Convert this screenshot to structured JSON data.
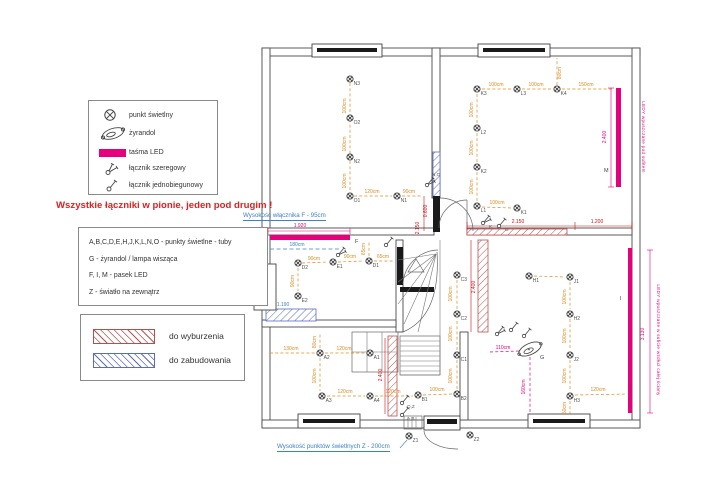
{
  "colors": {
    "led": "#e6007e",
    "dim_orange": "#dd8a1e",
    "dim_red": "#cc1111",
    "blue": "#3b82c4",
    "hatch_red": "#c0504d",
    "hatch_blue": "#5b6bbf",
    "wall": "#4a4a4a",
    "label": "#555555"
  },
  "symbol_legend": {
    "items": [
      {
        "icon": "light-point-icon",
        "label": "punkt świetlny"
      },
      {
        "icon": "chandelier-icon",
        "label": "żyrandol"
      },
      {
        "icon": "led-strip-icon",
        "label": "taśma LED"
      },
      {
        "icon": "series-switch-icon",
        "label": "łącznik szeregowy"
      },
      {
        "icon": "single-pole-switch-icon",
        "label": "łącznik jednobiegunowy"
      }
    ]
  },
  "warning": "Wszystkie łączniki w pionie, jeden pod drugim !",
  "letter_legend": {
    "lines": [
      "A,B,C,D,E,H,J,K,L,N,O - punkty świetlne - tuby",
      "G - żyrandol / lampa wisząca",
      "F, I, M - pasek LED",
      "Z - światło na zewnątrz"
    ]
  },
  "hatch_legend": {
    "items": [
      {
        "variant": "red",
        "label": "do wyburzenia"
      },
      {
        "variant": "blue",
        "label": "do zabudowania"
      }
    ]
  },
  "annotations": {
    "switch_f": "Wysokość włącznika F - 95cm",
    "lights_z": "Wysokość punktów świetlnych Z - 200cm"
  },
  "plan": {
    "walls": [
      [
        262,
        48,
        378,
        8
      ],
      [
        262,
        48,
        8,
        380
      ],
      [
        632,
        48,
        8,
        380
      ],
      [
        262,
        420,
        378,
        8
      ],
      [
        432,
        48,
        8,
        150
      ],
      [
        262,
        228,
        172,
        7
      ],
      [
        467,
        228,
        165,
        7
      ],
      [
        396,
        240,
        7,
        92
      ],
      [
        262,
        320,
        134,
        7
      ],
      [
        460,
        332,
        8,
        88
      ]
    ],
    "dark_rects": [
      [
        433,
        196,
        7,
        36
      ],
      [
        397,
        247,
        6,
        38
      ],
      [
        400,
        287,
        34,
        5
      ]
    ],
    "hatches": [
      {
        "v": "blue",
        "x": 433,
        "y": 152,
        "w": 7,
        "h": 46
      },
      {
        "v": "blue",
        "x": 266,
        "y": 309,
        "w": 50,
        "h": 12
      },
      {
        "v": "red",
        "x": 467,
        "y": 229,
        "w": 100,
        "h": 6
      },
      {
        "v": "red",
        "x": 478,
        "y": 240,
        "w": 10,
        "h": 92
      },
      {
        "v": "red",
        "x": 388,
        "y": 336,
        "w": 9,
        "h": 80
      }
    ],
    "windows": [
      {
        "x": 312,
        "y": 44,
        "w": 70,
        "h": 13,
        "bar": [
          317,
          48,
          60,
          4
        ]
      },
      {
        "x": 478,
        "y": 44,
        "w": 72,
        "h": 13,
        "bar": [
          483,
          48,
          62,
          4
        ]
      },
      {
        "x": 254,
        "y": 264,
        "w": 22,
        "h": 46,
        "bar": [
          260,
          272,
          7,
          30
        ]
      },
      {
        "x": 298,
        "y": 414,
        "w": 62,
        "h": 14,
        "bar": [
          303,
          419,
          52,
          4
        ]
      },
      {
        "x": 528,
        "y": 414,
        "w": 62,
        "h": 14,
        "bar": [
          533,
          419,
          52,
          4
        ]
      },
      {
        "x": 424,
        "y": 416,
        "w": 36,
        "h": 14,
        "bar": [
          427,
          419,
          30,
          5
        ]
      }
    ],
    "extra_rects": [
      [
        352,
        332,
        46,
        40
      ],
      [
        400,
        336,
        40,
        39
      ],
      [
        404,
        416,
        18,
        13
      ]
    ],
    "extra_lines": [
      [
        367,
        332,
        367,
        372
      ],
      [
        382,
        332,
        382,
        372
      ],
      [
        352,
        352,
        398,
        352
      ],
      [
        400,
        341,
        440,
        341
      ],
      [
        400,
        346,
        440,
        346
      ],
      [
        400,
        351,
        440,
        351
      ],
      [
        400,
        356,
        440,
        356
      ],
      [
        400,
        361,
        440,
        361
      ],
      [
        400,
        366,
        440,
        366
      ],
      [
        400,
        371,
        440,
        371
      ],
      [
        440,
        240,
        440,
        375
      ],
      [
        400,
        375,
        440,
        375
      ],
      [
        436,
        254,
        398,
        260
      ],
      [
        436,
        254,
        398,
        282
      ],
      [
        436,
        254,
        398,
        304
      ],
      [
        436,
        254,
        404,
        324
      ],
      [
        436,
        254,
        418,
        332
      ],
      [
        408,
        417,
        408,
        429
      ],
      [
        412,
        417,
        412,
        429
      ],
      [
        416,
        417,
        416,
        429
      ]
    ],
    "extra_paths": [
      "M 403,332 Q 441,316 437,252",
      "M 440,198 A 33,33 0 0 1 473,231",
      "M 467,200 A 28,28 0 0 0 439,228",
      "M 467,200 L 467,228",
      "M 403,284 A 36,36 0 0 1 438,250",
      "M 424,431 A 33,19 0 0 0 458,449",
      "M 408,272 L 424,272 L 416,259 Z"
    ],
    "led_strips": [
      {
        "id": "F",
        "x": 270,
        "y": 235,
        "w": 80,
        "h": 5,
        "lx": 355,
        "ly": 243
      },
      {
        "id": "M",
        "x": 616,
        "y": 88,
        "w": 5,
        "h": 99,
        "lx": 604,
        "ly": 172
      },
      {
        "id": "I",
        "x": 628,
        "y": 248,
        "w": 4,
        "h": 165,
        "lx": 620,
        "ly": 300
      }
    ],
    "lights": [
      {
        "label": "N3",
        "x": 350,
        "y": 79
      },
      {
        "label": "O2",
        "x": 350,
        "y": 118
      },
      {
        "label": "N2",
        "x": 350,
        "y": 157
      },
      {
        "label": "O1",
        "x": 350,
        "y": 196
      },
      {
        "label": "N1",
        "x": 397,
        "y": 196
      },
      {
        "label": "K3",
        "x": 477,
        "y": 89
      },
      {
        "label": "L3",
        "x": 517,
        "y": 89
      },
      {
        "label": "K4",
        "x": 557,
        "y": 89
      },
      {
        "label": "L2",
        "x": 477,
        "y": 128
      },
      {
        "label": "K2",
        "x": 477,
        "y": 167
      },
      {
        "label": "L1",
        "x": 477,
        "y": 206
      },
      {
        "label": "K1",
        "x": 517,
        "y": 208
      },
      {
        "label": "D2",
        "x": 298,
        "y": 263
      },
      {
        "label": "E1",
        "x": 333,
        "y": 262
      },
      {
        "label": "D1",
        "x": 369,
        "y": 261
      },
      {
        "label": "E2",
        "x": 298,
        "y": 296
      },
      {
        "label": "A2",
        "x": 320,
        "y": 353
      },
      {
        "label": "A1",
        "x": 370,
        "y": 353
      },
      {
        "label": "A3",
        "x": 322,
        "y": 396
      },
      {
        "label": "A4",
        "x": 370,
        "y": 396
      },
      {
        "label": "B1",
        "x": 418,
        "y": 395
      },
      {
        "label": "B2",
        "x": 457,
        "y": 394
      },
      {
        "label": "C1",
        "x": 457,
        "y": 355
      },
      {
        "label": "C2",
        "x": 457,
        "y": 314
      },
      {
        "label": "C3",
        "x": 457,
        "y": 275
      },
      {
        "label": "H1",
        "x": 529,
        "y": 276
      },
      {
        "label": "J1",
        "x": 570,
        "y": 277
      },
      {
        "label": "H2",
        "x": 570,
        "y": 314
      },
      {
        "label": "J2",
        "x": 570,
        "y": 355
      },
      {
        "label": "H3",
        "x": 570,
        "y": 396
      },
      {
        "label": "Z1",
        "x": 409,
        "y": 436
      },
      {
        "label": "Z2",
        "x": 470,
        "y": 435
      }
    ],
    "chandelier": {
      "label": "G",
      "x": 530,
      "y": 349,
      "lx": 540,
      "ly": 359
    },
    "switches": [
      {
        "x": 427,
        "y": 185,
        "v": "series",
        "l": "N,O",
        "lx": 432,
        "ly": 176
      },
      {
        "x": 338,
        "y": 255,
        "v": "series",
        "l": "",
        "lx": 0,
        "ly": 0
      },
      {
        "x": 386,
        "y": 245,
        "v": "single",
        "l": "",
        "lx": 0,
        "ly": 0
      },
      {
        "x": 483,
        "y": 223,
        "v": "series",
        "l": "K",
        "lx": 489,
        "ly": 228
      },
      {
        "x": 499,
        "y": 226,
        "v": "single",
        "l": "G",
        "lx": 505,
        "ly": 231
      },
      {
        "x": 497,
        "y": 334,
        "v": "series",
        "l": "",
        "lx": 0,
        "ly": 0
      },
      {
        "x": 511,
        "y": 330,
        "v": "single",
        "l": "",
        "lx": 0,
        "ly": 0
      },
      {
        "x": 524,
        "y": 336,
        "v": "single",
        "l": "",
        "lx": 0,
        "ly": 0
      },
      {
        "x": 402,
        "y": 403,
        "v": "single",
        "l": "O,Z",
        "lx": 407,
        "ly": 408
      },
      {
        "x": 402,
        "y": 415,
        "v": "single",
        "l": "A,B",
        "lx": 407,
        "ly": 420
      }
    ],
    "conn_lines": [
      [
        350,
        83,
        350,
        192,
        "o"
      ],
      [
        354,
        196,
        392,
        196,
        "o"
      ],
      [
        402,
        196,
        422,
        196,
        "o"
      ],
      [
        482,
        89,
        512,
        89,
        "o"
      ],
      [
        522,
        89,
        552,
        89,
        "o"
      ],
      [
        562,
        89,
        613,
        89,
        "o"
      ],
      [
        557,
        85,
        557,
        58,
        "o"
      ],
      [
        477,
        94,
        477,
        123,
        "o"
      ],
      [
        477,
        133,
        477,
        162,
        "o"
      ],
      [
        477,
        172,
        477,
        201,
        "o"
      ],
      [
        482,
        207,
        512,
        208,
        "o"
      ],
      [
        302,
        263,
        328,
        262,
        "o"
      ],
      [
        338,
        262,
        364,
        261,
        "o"
      ],
      [
        374,
        261,
        394,
        261,
        "o"
      ],
      [
        369,
        256,
        369,
        241,
        "o"
      ],
      [
        298,
        268,
        298,
        291,
        "o"
      ],
      [
        270,
        353,
        315,
        353,
        "o"
      ],
      [
        325,
        353,
        365,
        353,
        "o"
      ],
      [
        320,
        348,
        320,
        333,
        "o"
      ],
      [
        320,
        358,
        320,
        391,
        "o"
      ],
      [
        327,
        396,
        365,
        396,
        "o"
      ],
      [
        375,
        396,
        413,
        396,
        "o"
      ],
      [
        423,
        395,
        452,
        394,
        "o"
      ],
      [
        457,
        389,
        457,
        360,
        "o"
      ],
      [
        457,
        350,
        457,
        319,
        "o"
      ],
      [
        457,
        309,
        457,
        280,
        "o"
      ],
      [
        534,
        276,
        565,
        277,
        "o"
      ],
      [
        570,
        282,
        570,
        309,
        "o"
      ],
      [
        570,
        319,
        570,
        350,
        "o"
      ],
      [
        570,
        360,
        570,
        391,
        "o"
      ],
      [
        575,
        395,
        627,
        394,
        "o"
      ],
      [
        570,
        401,
        570,
        414,
        "o"
      ],
      [
        490,
        352,
        519,
        351,
        "m"
      ],
      [
        530,
        357,
        530,
        413,
        "m"
      ],
      [
        270,
        249,
        340,
        249,
        "b"
      ]
    ],
    "dim_lines": [
      [
        268,
        231,
        350,
        231,
        "m"
      ],
      [
        268,
        228,
        268,
        234,
        "m"
      ],
      [
        350,
        228,
        350,
        234,
        "m"
      ],
      [
        611,
        88,
        611,
        187,
        "m"
      ],
      [
        608,
        88,
        614,
        88,
        "m"
      ],
      [
        608,
        187,
        614,
        187,
        "m"
      ],
      [
        650,
        250,
        650,
        413,
        "m"
      ],
      [
        647,
        250,
        653,
        250,
        "m"
      ],
      [
        647,
        413,
        653,
        413,
        "m"
      ],
      [
        467,
        226,
        632,
        226,
        "r"
      ],
      [
        467,
        222,
        467,
        230,
        "r"
      ],
      [
        575,
        222,
        575,
        230,
        "r"
      ],
      [
        632,
        222,
        632,
        230,
        "r"
      ],
      [
        471,
        240,
        471,
        332,
        "r"
      ],
      [
        385,
        338,
        385,
        414,
        "r"
      ],
      [
        424,
        196,
        424,
        231,
        "r"
      ],
      [
        400,
        448,
        407,
        440,
        "b"
      ]
    ],
    "dim_texts": [
      [
        "100cm",
        346,
        106,
        "o",
        1
      ],
      [
        "100cm",
        346,
        144,
        "o",
        1
      ],
      [
        "100cm",
        346,
        181,
        "o",
        1
      ],
      [
        "120cm",
        372,
        193,
        "o",
        0
      ],
      [
        "90cm",
        409,
        193,
        "o",
        0
      ],
      [
        "100cm",
        496,
        86,
        "o",
        0
      ],
      [
        "100cm",
        536,
        86,
        "o",
        0
      ],
      [
        "150cm",
        586,
        86,
        "o",
        0
      ],
      [
        "80cm",
        561,
        73,
        "o",
        1
      ],
      [
        "100cm",
        473,
        110,
        "o",
        1
      ],
      [
        "100cm",
        473,
        148,
        "o",
        1
      ],
      [
        "100cm",
        473,
        187,
        "o",
        1
      ],
      [
        "100cm",
        497,
        204,
        "o",
        0
      ],
      [
        "90cm",
        314,
        260,
        "o",
        0
      ],
      [
        "90cm",
        350,
        258,
        "o",
        0
      ],
      [
        "65cm",
        383,
        258,
        "o",
        0
      ],
      [
        "65cm",
        365,
        249,
        "o",
        1
      ],
      [
        "90cm",
        294,
        281,
        "o",
        1
      ],
      [
        "130cm",
        291,
        350,
        "o",
        0
      ],
      [
        "120cm",
        344,
        350,
        "o",
        0
      ],
      [
        "80cm",
        316,
        342,
        "o",
        1
      ],
      [
        "100cm",
        316,
        376,
        "o",
        1
      ],
      [
        "120cm",
        345,
        393,
        "o",
        0
      ],
      [
        "120cm",
        393,
        393,
        "o",
        0
      ],
      [
        "100cm",
        437,
        391,
        "o",
        0
      ],
      [
        "100cm",
        452,
        376,
        "o",
        1
      ],
      [
        "100cm",
        452,
        334,
        "o",
        1
      ],
      [
        "100cm",
        452,
        294,
        "o",
        1
      ],
      [
        "100cm",
        566,
        297,
        "o",
        1
      ],
      [
        "100cm",
        566,
        336,
        "o",
        1
      ],
      [
        "100cm",
        566,
        376,
        "o",
        1
      ],
      [
        "120cm",
        598,
        391,
        "o",
        0
      ],
      [
        "50cm",
        566,
        408,
        "o",
        1
      ],
      [
        "1.920",
        300,
        227,
        "m",
        0
      ],
      [
        "2.400",
        606,
        137,
        "m",
        1
      ],
      [
        "3.130",
        644,
        334,
        "m",
        1
      ],
      [
        "110cm",
        503,
        349,
        "m",
        0
      ],
      [
        "160cm",
        525,
        387,
        "m",
        1
      ],
      [
        "2.150",
        518,
        223,
        "r",
        0
      ],
      [
        "1.200",
        597,
        223,
        "r",
        0
      ],
      [
        "0.600",
        427,
        211,
        "r",
        1
      ],
      [
        "2.150",
        419,
        228,
        "r",
        1
      ],
      [
        "2.400",
        475,
        287,
        "r",
        1
      ],
      [
        "2.400",
        382,
        375,
        "r",
        1
      ],
      [
        "180cm",
        297,
        246,
        "b",
        0
      ],
      [
        "1.190",
        283,
        306,
        "b",
        0
      ]
    ],
    "vtexts": [
      {
        "t": "LEDY wpuszczane pod sufitem",
        "x": 642,
        "y": 137
      },
      {
        "t": "LEDY wpuszczane w suficie wzdłuż całej ściany",
        "x": 657,
        "y": 340
      }
    ]
  }
}
